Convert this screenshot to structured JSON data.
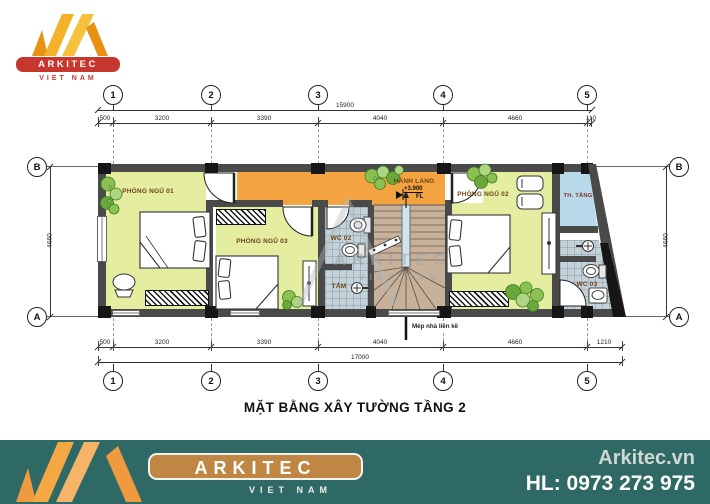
{
  "logo": {
    "brand": "ARKITEC",
    "country": "VIET NAM"
  },
  "footer": {
    "website": "Arkitec.vn",
    "hotline": "HL: 0973 273 975",
    "brand": "ARKITEC",
    "country": "VIET NAM"
  },
  "title": "MẶT BẰNG XÂY TƯỜNG TẦNG 2",
  "watermark": {
    "brand": "ARKITEC",
    "country": "VIET NAM"
  },
  "grid": {
    "g1": "1",
    "g2": "2",
    "g3": "3",
    "g4": "4",
    "g5": "5",
    "ga": "A",
    "gb": "B"
  },
  "dims": {
    "top_total": "15900",
    "bottom_total": "17000",
    "side_left": "4660",
    "side_right": "4660",
    "top_segments": [
      "500",
      "3200",
      "3390",
      "4040",
      "4660",
      "110"
    ],
    "bottom_segments": [
      "500",
      "3200",
      "3390",
      "4040",
      "4660",
      "1210"
    ]
  },
  "rooms": {
    "bedroom1": "PHÒNG NGỦ 01",
    "bedroom2": "PHÒNG NGỦ 02",
    "bedroom3": "PHÒNG NGỦ 03",
    "corridor": "HÀNH LANG",
    "wc2": "WC 02",
    "bath": "TẮM",
    "wc3": "WC 03",
    "void_room": "TH. TẦNG"
  },
  "annotations": {
    "level": "+3.900",
    "level_suffix": "FL",
    "adjacent_note": "Mép nhà liền kề"
  },
  "colors": {
    "room_green": "#e4eda0",
    "corridor_orange": "#f3a440",
    "stair_tan": "#c8b19b",
    "tile_gray": "#c3d2d8",
    "void_blue": "#b7d9e9",
    "wall_gray": "#4a4a4a",
    "footer_teal": "#2e6965",
    "brand_orange": "#f2a143",
    "brand_red": "#c8372d"
  }
}
